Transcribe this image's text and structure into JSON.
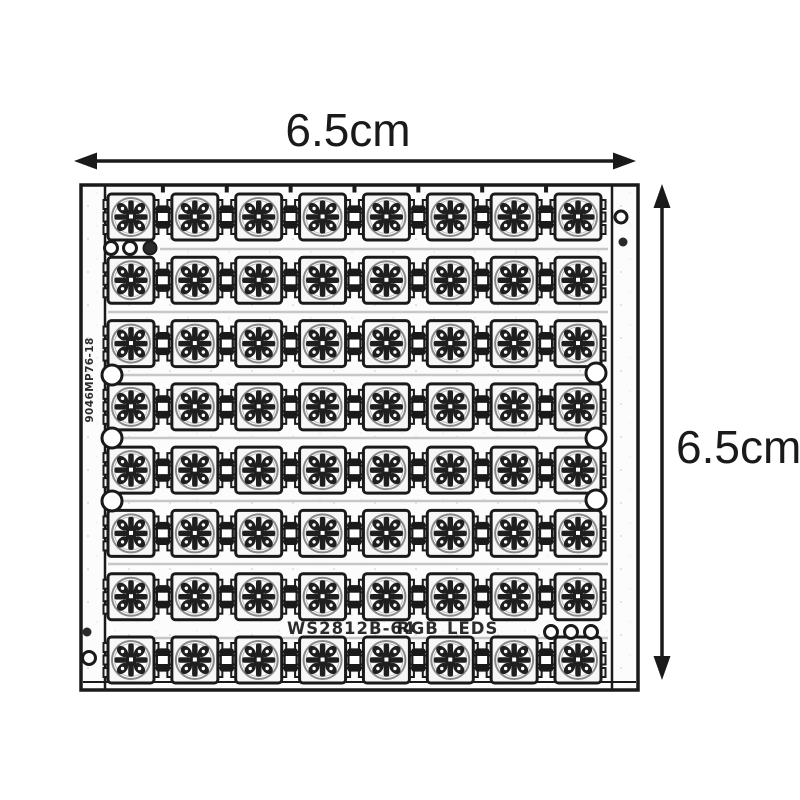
{
  "annotations": {
    "width_label": "6.5cm",
    "height_label": "6.5cm"
  },
  "pcb": {
    "silkscreen": {
      "model": "WS2812B-64",
      "type": "RGB",
      "leds": "LEDS"
    },
    "side_marking": "9046MP76-18",
    "grid": {
      "rows": 8,
      "cols": 8,
      "total_leds": 64
    }
  },
  "style": {
    "ink": "#1a1a1a",
    "board_fill": "#fcfcfc",
    "trace": "#c7c7c7",
    "lens_stroke": "#8a8a8a"
  }
}
